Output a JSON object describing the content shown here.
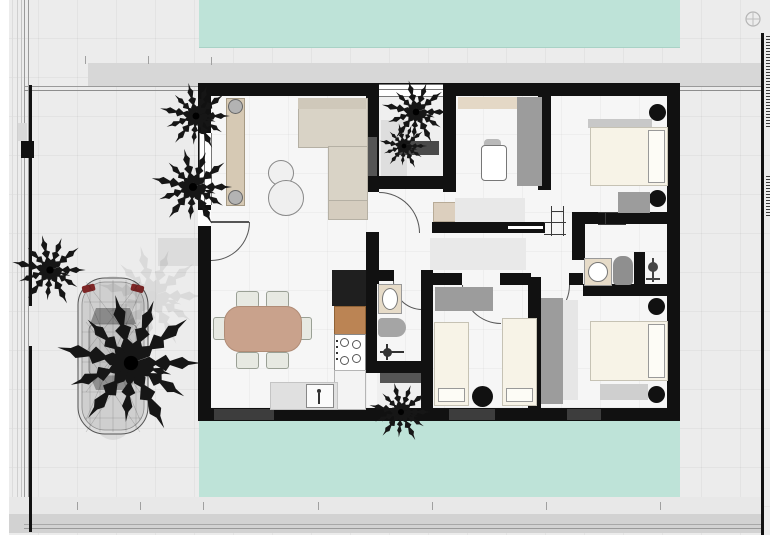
{
  "meta": {
    "scene": "architectural-floor-plan",
    "view": "top-down-render",
    "canvas": {
      "width": 770,
      "height": 535
    },
    "visible_text": "none"
  },
  "palette": {
    "wall": "#111111",
    "pool": "#bee3d8",
    "exterior": "#ececec",
    "interior": "#f6f6f6",
    "terrace": "#d7d7d7",
    "band": "#d2d2d2",
    "bed": "#f7f3e7",
    "wardrobe": "#9c9c9c",
    "sideboard": "#d6c9b4",
    "sofa": "#d9d3c6",
    "dining": "#c9a28c",
    "counter_wood": "#bb8454",
    "fixture_beige": "#e6dbc8",
    "plant": "#161616",
    "car_body": "#dcdcdc",
    "car_accent": "#7e2626"
  },
  "objects": {
    "pool_top": "swimming-pool",
    "pool_bottom": "swimming-pool",
    "car": "car-top-view-wireframe",
    "palms": "palm-trees",
    "living": [
      "sideboard",
      "l-shaped-sofa",
      "round-coffee-tables",
      "entry-door"
    ],
    "dining": [
      "dining-table",
      "six-chairs"
    ],
    "kitchen": [
      "tall-cabinet",
      "wood-counter",
      "stove-4-burners",
      "counter",
      "island-sink"
    ],
    "bathroom_small": [
      "sink",
      "toilet",
      "shower-fixture"
    ],
    "courtyard": [
      "palm-tree",
      "bench",
      "paving"
    ],
    "office": [
      "shelf",
      "wardrobe",
      "desk",
      "chair"
    ],
    "bedroom_top_right": [
      "double-bed",
      "pillow-board",
      "bedside-pots",
      "wardrobe"
    ],
    "bathroom_ensuite": [
      "sink",
      "shower",
      "toilet-symbol"
    ],
    "bedroom_bottom_right": [
      "double-bed",
      "pillow-board",
      "bedside-pots",
      "wardrobe",
      "rug"
    ],
    "bedroom_twin": [
      "single-bed",
      "single-bed",
      "round-nightstand",
      "wardrobe"
    ],
    "site": [
      "property-line-left",
      "property-line-right",
      "terrace-frame",
      "survey-marks",
      "north-glyph"
    ]
  }
}
